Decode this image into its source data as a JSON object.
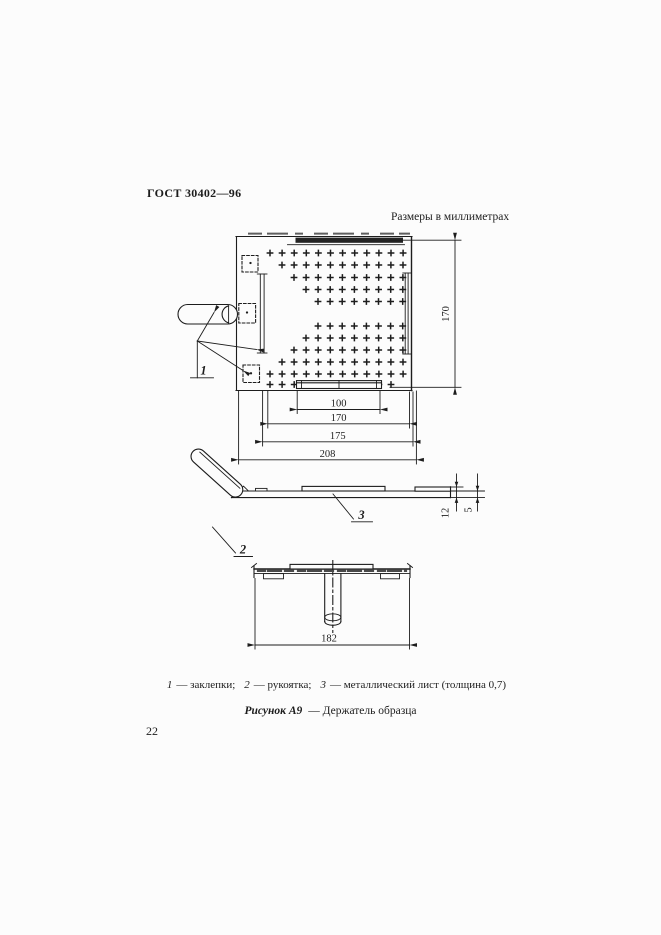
{
  "page": {
    "number": "22",
    "background": "#fcfcfc",
    "ink": "#1d1d1d"
  },
  "header": {
    "doc_code": "ГОСТ 30402—96",
    "units_note": "Размеры в миллиметрах"
  },
  "figure": {
    "caption": {
      "label": "Рисунок А9",
      "rest": "— Держатель образца"
    },
    "legend": {
      "item1_num": "1",
      "item1_text": "— заклепки;",
      "item2_num": "2",
      "item2_text": "— рукоятка;",
      "item3_num": "3",
      "item3_text": "— металлический лист (толщина 0,7)"
    },
    "part_labels": {
      "rivets": "1",
      "handle": "2",
      "sheet": "3"
    },
    "dimensions": {
      "plate_height": "170",
      "clamp_strip_width": "100",
      "window_width": "170",
      "sheet_width": "175",
      "overall_width": "208",
      "profile_height": "12",
      "edge_height": "5",
      "inner_width": "182"
    }
  },
  "drawing": {
    "cross": {
      "step": 12.1,
      "r": 3.4
    },
    "cross_rows": [
      {
        "y": 253,
        "x0": 270,
        "n": 12
      },
      {
        "y": 265,
        "x0": 282,
        "n": 11
      },
      {
        "y": 277.5,
        "x0": 294,
        "n": 10
      },
      {
        "y": 289.5,
        "x0": 306,
        "n": 9
      },
      {
        "y": 301.5,
        "x0": 318,
        "n": 8
      },
      {
        "y": 326,
        "x0": 318,
        "n": 8
      },
      {
        "y": 338,
        "x0": 306,
        "n": 9
      },
      {
        "y": 350,
        "x0": 294,
        "n": 10
      },
      {
        "y": 362,
        "x0": 282,
        "n": 11
      },
      {
        "y": 374,
        "x0": 270,
        "n": 12
      },
      {
        "y": 384.5,
        "x0": 270,
        "n": 11
      }
    ]
  }
}
